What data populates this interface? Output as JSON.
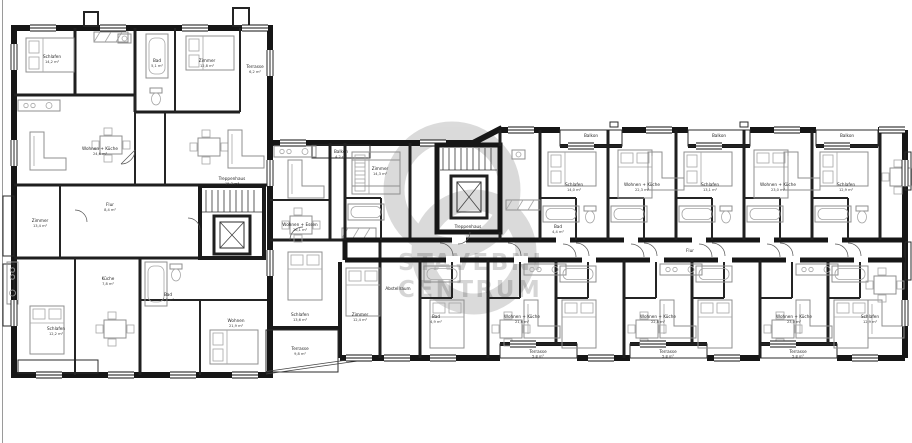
{
  "watermark": {
    "line1": "STAVEBNI",
    "line2": "CENTRUM"
  },
  "rooms": [
    {
      "name": "Schlafen",
      "area": "14,2 m²"
    },
    {
      "name": "Wohnen + Küche",
      "area": "24,6 m²"
    },
    {
      "name": "Bad",
      "area": "5,1 m²"
    },
    {
      "name": "Zimmer",
      "area": "12,8 m²"
    },
    {
      "name": "Flur",
      "area": "8,4 m²"
    },
    {
      "name": "Terrasse",
      "area": "6,2 m²"
    },
    {
      "name": "Zimmer",
      "area": "13,4 m²"
    },
    {
      "name": "Küche",
      "area": "7,8 m²"
    },
    {
      "name": "Schlafen",
      "area": "12,2 m²"
    },
    {
      "name": "Wohnen",
      "area": "21,9 m²"
    },
    {
      "name": "Bad",
      "area": "4,6 m²"
    },
    {
      "name": "Treppenhaus",
      "area": "15,3 m²"
    },
    {
      "name": "Wohnen + Essen",
      "area": "26,1 m²"
    },
    {
      "name": "Schlafen",
      "area": "13,6 m²"
    },
    {
      "name": "Zimmer",
      "area": "12,4 m²"
    },
    {
      "name": "Terrasse",
      "area": "9,8 m²"
    },
    {
      "name": "Balkon",
      "area": "4,2 m²"
    },
    {
      "name": "Treppenhaus",
      "area": "14,7 m²"
    },
    {
      "name": "Schlafen",
      "area": "14,0 m²"
    },
    {
      "name": "Bad",
      "area": "4,4 m²"
    },
    {
      "name": "Wohnen + Küche",
      "area": "22,3 m²"
    },
    {
      "name": "Schlafen",
      "area": "13,1 m²"
    },
    {
      "name": "Wohnen + Küche",
      "area": "23,0 m²"
    },
    {
      "name": "Schlafen",
      "area": "12,9 m²"
    },
    {
      "name": "Wohnen + Küche",
      "area": "21,6 m²"
    },
    {
      "name": "Terrasse",
      "area": "5,8 m²"
    },
    {
      "name": "Flur",
      "area": "11,2 m²"
    },
    {
      "name": "Zimmer",
      "area": "14,3 m²"
    },
    {
      "name": "Bad",
      "area": "4,9 m²"
    },
    {
      "name": "Wohnen + Küche",
      "area": "22,8 m²"
    },
    {
      "name": "Balkon",
      "area": "4,0 m²"
    },
    {
      "name": "Abstellraum",
      "area": "2,1 m²"
    }
  ]
}
